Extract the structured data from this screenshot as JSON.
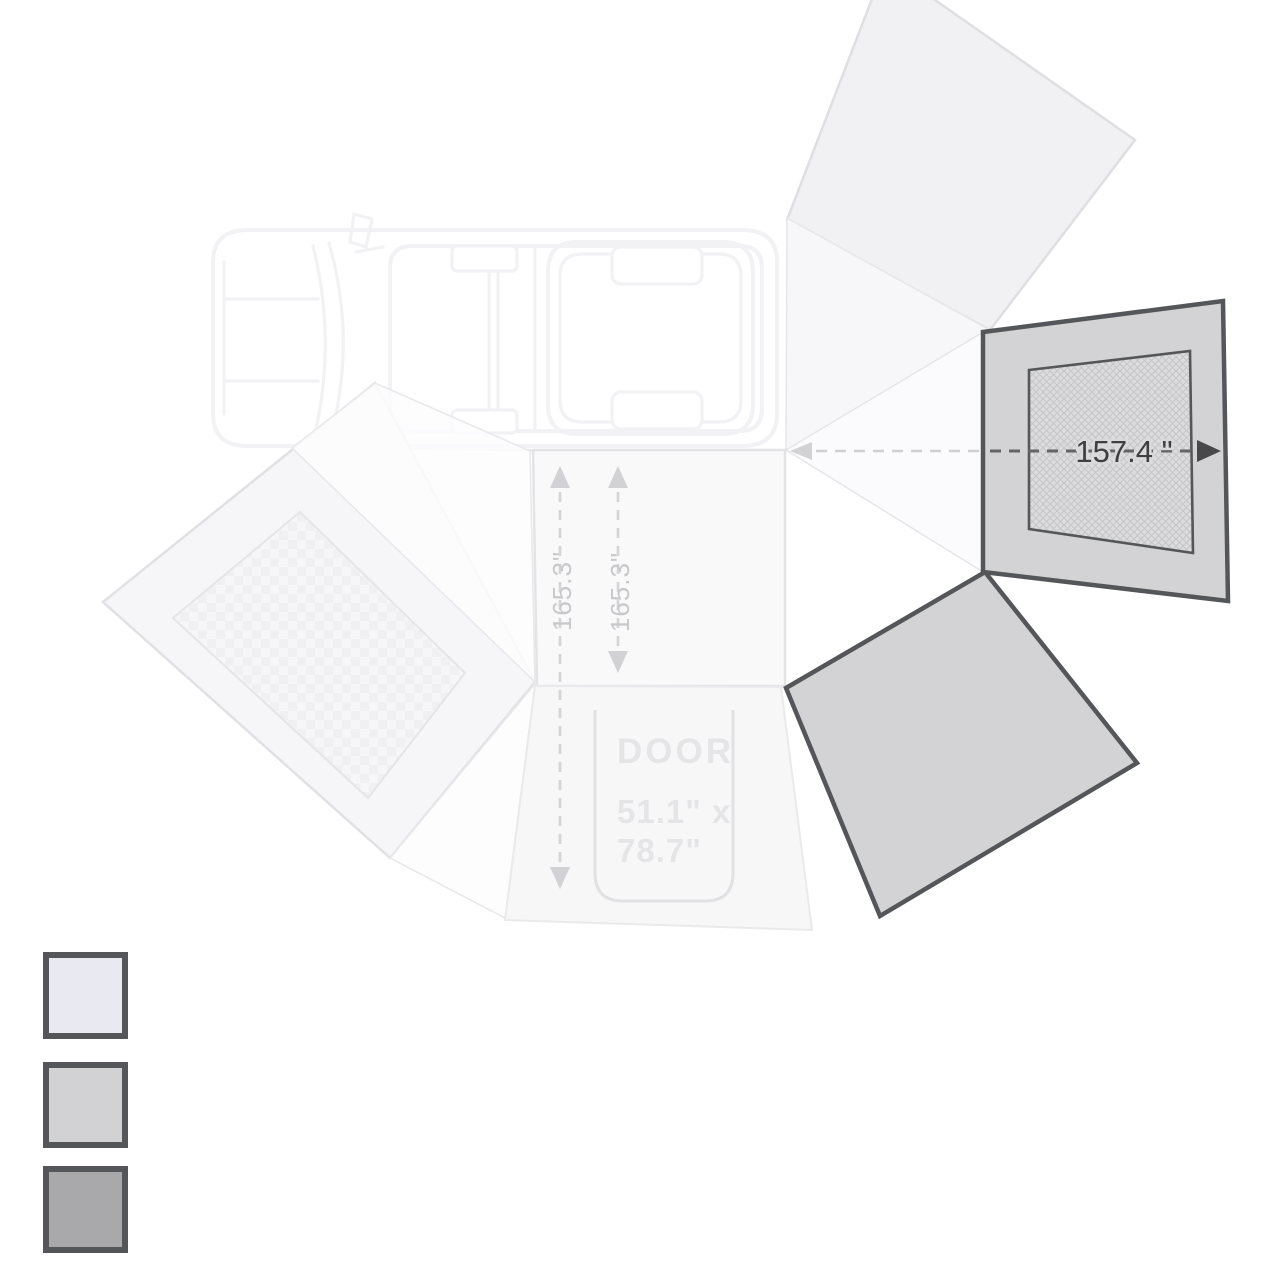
{
  "diagram": {
    "type": "vehicle-270-awning-footprint-top-view",
    "labels": {
      "width_dim": "157.4 \"",
      "depth_dim_left": "165.3\"",
      "depth_dim_right": "165.3\"",
      "door_title": "DOOR",
      "door_dim_line1": "51.1\" x",
      "door_dim_line2": "78.7\""
    },
    "colors": {
      "outline_dark": "#54565a",
      "panel_gray": "#d3d3d5",
      "window_hatch_base": "#dcdcde",
      "window_hatch_line": "#c6c6c9",
      "dim_text_dark": "#3f3f3f",
      "dim_text_light": "#c9c9cc",
      "faint_panel_fill": "#f6f6f8",
      "faint_text": "#d8d8da"
    }
  },
  "legend": {
    "items": [
      {
        "name": "panel-lightest",
        "color": "#e9e9f1"
      },
      {
        "name": "panel-light-gray",
        "color": "#d2d2d4"
      },
      {
        "name": "panel-medium-gray",
        "color": "#a9a9ab"
      }
    ]
  }
}
